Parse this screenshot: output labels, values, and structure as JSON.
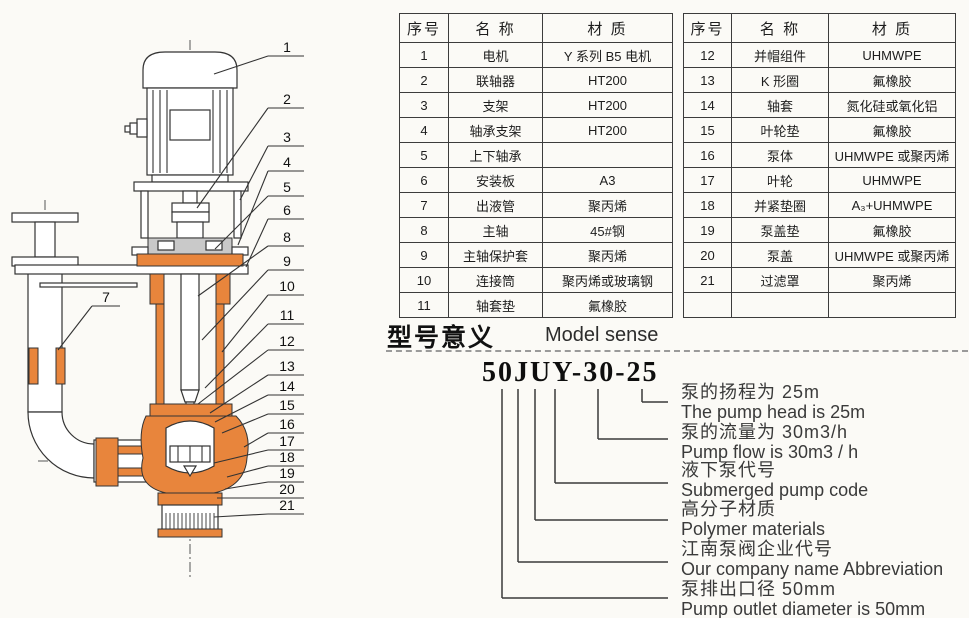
{
  "diagram": {
    "description": "submerged pump sectional drawing",
    "callouts_right": [
      "1",
      "2",
      "3",
      "4",
      "5",
      "6",
      "8",
      "9",
      "10",
      "11",
      "12",
      "13",
      "14",
      "15",
      "16",
      "17",
      "18",
      "19",
      "20",
      "21"
    ],
    "callout_left": "7"
  },
  "parts_tables": [
    {
      "headers": [
        "序号",
        "名 称",
        "材 质"
      ],
      "rows": [
        [
          "1",
          "电机",
          "Y 系列 B5 电机"
        ],
        [
          "2",
          "联轴器",
          "HT200"
        ],
        [
          "3",
          "支架",
          "HT200"
        ],
        [
          "4",
          "轴承支架",
          "HT200"
        ],
        [
          "5",
          "上下轴承",
          ""
        ],
        [
          "6",
          "安装板",
          "A3"
        ],
        [
          "7",
          "出液管",
          "聚丙烯"
        ],
        [
          "8",
          "主轴",
          "45#钢"
        ],
        [
          "9",
          "主轴保护套",
          "聚丙烯"
        ],
        [
          "10",
          "连接筒",
          "聚丙烯或玻璃钢"
        ],
        [
          "11",
          "轴套垫",
          "氟橡胶"
        ]
      ]
    },
    {
      "headers": [
        "序号",
        "名 称",
        "材 质"
      ],
      "rows": [
        [
          "12",
          "并帽组件",
          "UHMWPE"
        ],
        [
          "13",
          "K 形圈",
          "氟橡胶"
        ],
        [
          "14",
          "轴套",
          "氮化硅或氧化铝"
        ],
        [
          "15",
          "叶轮垫",
          "氟橡胶"
        ],
        [
          "16",
          "泵体",
          "UHMWPE 或聚丙烯"
        ],
        [
          "17",
          "叶轮",
          "UHMWPE"
        ],
        [
          "18",
          "并紧垫圈",
          "A₃+UHMWPE"
        ],
        [
          "19",
          "泵盖垫",
          "氟橡胶"
        ],
        [
          "20",
          "泵盖",
          "UHMWPE 或聚丙烯"
        ],
        [
          "21",
          "过滤罩",
          "聚丙烯"
        ],
        [
          "",
          "",
          ""
        ]
      ]
    }
  ],
  "model_section": {
    "title_zh": "型号意义",
    "title_en": "Model sense",
    "model_number": "50JUY-30-25",
    "explanations": [
      {
        "zh": "泵的扬程为 25m",
        "en": "The pump head is 25m"
      },
      {
        "zh": "泵的流量为 30m3/h",
        "en": "Pump flow is 30m3 / h"
      },
      {
        "zh": "液下泵代号",
        "en": "Submerged pump code"
      },
      {
        "zh": "高分子材质",
        "en": "Polymer materials"
      },
      {
        "zh": "江南泵阀企业代号",
        "en": "Our company name Abbreviation"
      },
      {
        "zh": "泵排出口径 50mm",
        "en": "Pump outlet diameter is 50mm"
      }
    ]
  },
  "colors": {
    "accent_orange": "#e8853c",
    "steel_gray": "#c9c9c9",
    "line": "#333333"
  }
}
